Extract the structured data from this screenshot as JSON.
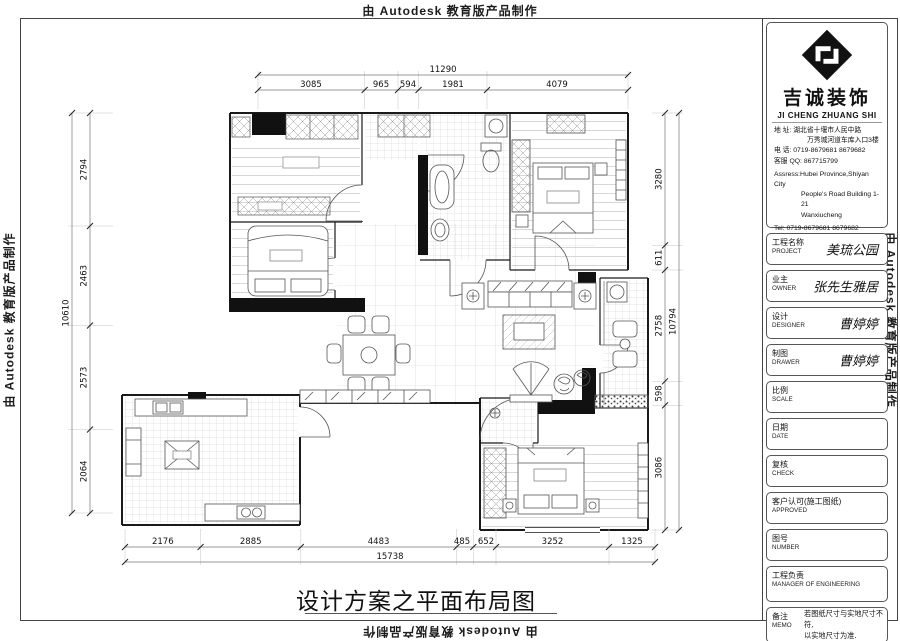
{
  "watermark": {
    "text": "由 Autodesk 教育版产品制作"
  },
  "drawing": {
    "title": "设计方案之平面布局图"
  },
  "company": {
    "name_cn": "吉诚装饰",
    "name_en": "JI CHENG ZHUANG SHI",
    "contact_lines": [
      "地  址: 湖北省十堰市人民中路",
      "万秀城河道车库入口3楼",
      "电  话: 0719-8679681   8679682",
      "客服 QQ: 867715799",
      "Assress:Hubei Province,Shiyan City",
      "People's Road Building 1-21",
      "Wanxiucheng",
      "Tel: 0719-8679681   8679682",
      "QQ: 867715799"
    ]
  },
  "fields": [
    {
      "zh": "工程名称",
      "en": "PROJECT",
      "value": "美琉公园"
    },
    {
      "zh": "业主",
      "en": "OWNER",
      "value": "张先生雅居"
    },
    {
      "zh": "设计",
      "en": "DESIGNER",
      "value": "曹婷婷"
    },
    {
      "zh": "制图",
      "en": "DRAWER",
      "value": "曹婷婷"
    },
    {
      "zh": "比例",
      "en": "SCALE",
      "value": ""
    },
    {
      "zh": "日期",
      "en": "DATE",
      "value": ""
    },
    {
      "zh": "复核",
      "en": "CHECK",
      "value": ""
    },
    {
      "zh": "客户认可(施工图纸)",
      "en": "APPROVED",
      "value": ""
    },
    {
      "zh": "图号",
      "en": "NUMBER",
      "value": ""
    },
    {
      "zh": "工程负责",
      "en": "MANAGER OF ENGINEERING",
      "value": ""
    },
    {
      "zh": "备注",
      "en": "MEMO",
      "value": "若图纸尺寸与实地尺寸不符,\n以实地尺寸为准."
    }
  ],
  "dimensions": {
    "top": {
      "total": "11290",
      "segments": [
        "3085",
        "965",
        "594",
        "1981",
        "4079"
      ]
    },
    "left": {
      "total": "10610",
      "segments": [
        "2794",
        "2463",
        "2573",
        "2064"
      ]
    },
    "right": {
      "total": "10794",
      "segments": [
        "3280",
        "611",
        "2758",
        "598",
        "3086"
      ]
    },
    "bottom": {
      "total": "15738",
      "segments": [
        "2176",
        "2885",
        "4483",
        "485",
        "652",
        "3252",
        "1325"
      ]
    }
  }
}
